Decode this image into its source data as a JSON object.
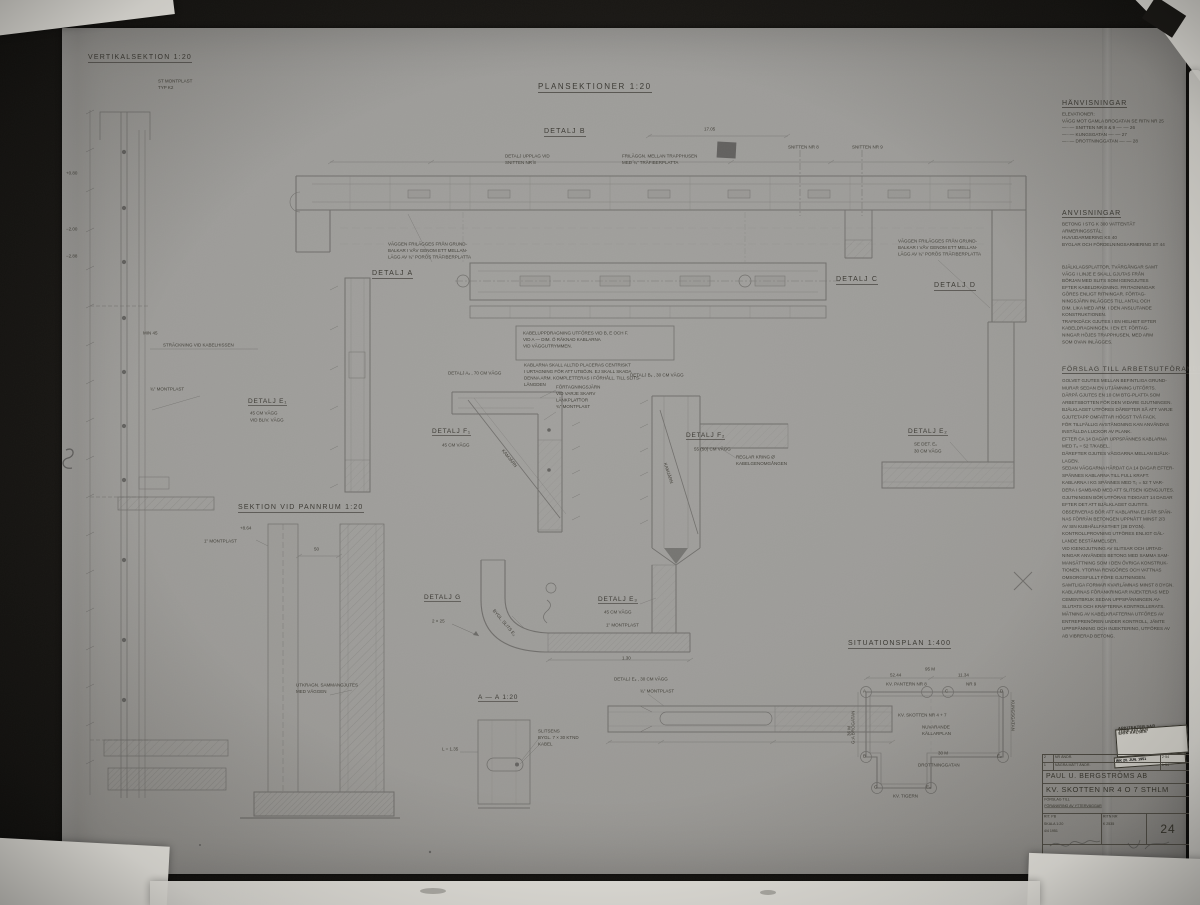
{
  "headings": {
    "vertical_section": "VERTIKALSEKTION 1:20",
    "plan_sections": "PLANSEKTIONER  1:20",
    "section_pannrum": "SEKTION VID PANNRUM  1:20",
    "situationsplan": "SITUATIONSPLAN  1:400",
    "section_aa": "A — A   1:20"
  },
  "labels": {
    "detail_a": "DETALJ A",
    "detail_b": "DETALJ B",
    "detail_c": "DETALJ C",
    "detail_d": "DETALJ D",
    "detail_e1": "DETALJ E₁",
    "detail_e1_sub": "45 CM VÄGG",
    "detail_e1_sub2": "VID BLIV. VÄGG",
    "detail_a2": "DETALJ A₂ , 70 CM VÄGG",
    "detail_b2": "DETALJ B₂ , 30 CM VÄGG",
    "detail_f1": "DETALJ F₁",
    "detail_f1_sub": "45 CM VÄGG",
    "detail_f2": "DETALJ F₂",
    "detail_f2_sub": "55 (50) CM VÄGG",
    "detail_e2": "DETALJ E₂",
    "detail_e2_sub": "SE DET. E₁",
    "detail_e2_sub2": "30 CM VÄGG",
    "detail_g": "DETALJ G",
    "detail_g_dim": "2 × 25",
    "detail_e3": "DETALJ E₃",
    "detail_e3_sub": "45 CM VÄGG",
    "detail_e3_sub2": "1\" MONTPLAST",
    "detail_e3b": "DETALJ E₃ , 30 CM VÄGG",
    "detail_e3b_sub": "¾\" MONTPLAST",
    "snitt8": "SNITTEN NR 8",
    "snitt9": "SNITTEN NR 9",
    "dim_1705": "17.05",
    "min45": "MIN 45",
    "stretch_note": "STRÄCKNING VID KABELHISSEN",
    "montplast34": "¾\" MONTPLAST",
    "montplast1": "1\" MONTPLAST",
    "level_864": "+8.64",
    "dim50": "50",
    "dim130": "1.30",
    "l135": "L = 1.35",
    "kamjarn": "KAMJÄRN",
    "bygl_slits": "BYGL. SLITS E₃",
    "level_080": "+0.80",
    "level_200": "−2.00",
    "level_288": "−2.88"
  },
  "notes": {
    "topleft": [
      "ST MONTPLAST",
      "TYP K2"
    ],
    "upplag": [
      "DETALJ UPPLAG VID",
      "SNITTEN NR 8"
    ],
    "frilaggn": [
      "FRILÄGGN. MELLAN TRAPPHUSEN",
      "MED ¾\" TRÄFIBERPLATTA"
    ],
    "frilagg_left": [
      "VÄGGEN FRILÄGGES FRÅN GRUND-",
      "BALKAR I VÅV GENOM ETT MELLAN-",
      "LÄGG AV ¾\" PORÖS TRÄFIBERPLATTA"
    ],
    "frilagg_right": [
      "VÄGGEN FRILÄGGES FRÅN GRUND-",
      "BALKAR I VÅV GENOM ETT MELLAN-",
      "LÄGG AV ¾\" PORÖS TRÄFIBERPLATTA"
    ],
    "boxed": [
      "KABELUPPDRAGNING UTFÖRES VID B, E OCH F.",
      "VID A  —  DIM. Ö RÄKNAD KABLARNA",
      "VID VÄGGUTRYMMEN."
    ],
    "kablarna": [
      "KABLARNA SKALL ALLTID PLACERAS CENTRISKT",
      "I URTAGNING FÖR ATT UTBÖJN. EJ SKALL SKADA",
      "DENNA ARM. KOMPLETTERAS I FÖRHÅLL. TILL SLITS-",
      "LÄNGDEN"
    ],
    "f1_notes": [
      "FÖRTAGNINGSJÄRN",
      "VID VARJE SKARV",
      "LÄNKPLATTOR",
      "¾\" MONTPLAST"
    ],
    "f2_note": [
      "REGLAR KRING Ø",
      "KABELGENOMGÅNGEN"
    ],
    "utkragn": [
      "UTKRAGN. SAMMANGJUTES",
      "MED VÄGGEN"
    ],
    "slits": [
      "SLITSENS",
      "BYGL. 7 × 30 KTND",
      "KABEL"
    ]
  },
  "references": {
    "title": "HÄNVISNINGAR",
    "lines": [
      "ELEVATIONER:",
      "VÄGG MOT GAMLA BROGATAN  SE RITN NR 25",
      " —··—   SNITTEN NR 8 & 9     —··—    26",
      " —··—   KUNGSGATAN         —··—    27",
      " —··—   DROTTNINGGATAN    —··—    28"
    ]
  },
  "instructions": {
    "title": "ANVISNINGAR",
    "lines": [
      "BETONG I STG  K 300  VATTENTÄT",
      "ARMERINGSSTÅL:",
      "HUVUDARMERING  KS 40",
      "BYGLAR OCH FÖRDELNINGSARMERING ST 44"
    ],
    "paragraph": [
      "BJÄLKLAGSPLATTOR, TVÄRGÅNGAR SAMT",
      "VÄGG I LINJE E SKALL GJUTAS FRÅN",
      "BÖRJAN MED SLITS SOM IGENGJUTES",
      "EFTER KABELDRAGNING. FRITAGNINGAR",
      "GÖRES ENLIGT RITNINGAR. FÖRTAG-",
      "NINGSJÄRN INLÄGGES TILL ANTAL OCH",
      "DIM. LIKA MED ARM. I DEN ANSLUTANDE",
      "KONSTRUKTIONEN.",
      "TRAFIKDÄCK GJUTES I EN HELHET EFTER",
      "KABELDRAGNINGEN. I EN ET. FÖRTAG-",
      "NINGAR HÖJES TRAPPHUSEN, MED ARM",
      "SOM OVAN INLÄGGES."
    ]
  },
  "work_proposal": {
    "title": "FÖRSLAG TILL ARBETSUTFÖRANDE",
    "lines": [
      "GOLVET GJUTES MELLAN BEFINTLIGA GRUND-",
      "MURAR SEDAN EN UTJÄMNING UTFÖRTS.",
      "DÄRPÅ GJUTES EN 10 CM BTG-PLATTA SOM",
      "ARBETSBOTTEN FÖR DEN VIDARE GJUTNINGEN.",
      "BJÄLKLAGET UTFÖRES DÄREFTER SÅ ATT VARJE",
      "GJUTETAPP OMFATTAR HÖGST TVÅ FACK.",
      "FÖR TILLFÄLLIG AVSTÄNGNING KAN ANVÄNDAS",
      "INSTÄLLDA LUCKOR AV PLANK.",
      "EFTER CA 14 DAGAR UPPSPÄNNES KABLARNA",
      "MED T₀ = 52 T/KABEL.",
      "DÄREFTER GJUTES VÄGGARNA MELLAN BJÄLK-",
      "LAGEN.",
      "SEDAN VÄGGARNA HÄRDAT CA 14 DAGAR EFTER-",
      "SPÄNNES KABLARNA TILL FULL KRAFT.",
      "KABLARNA I KG SPÄNNES MED T₀ = 52 T VAR-",
      "DERA I SAMBAND MED ATT SLITSEN IGENGJUTES.",
      "GJUTNINGEN BÖR UTFÖRAS TIDIGAST 14 DAGAR",
      "EFTER DET ATT BJÄLKLAGET GJUTITS.",
      "OBSERVERAS BÖR ATT KABLARNA EJ FÅR SPÄN-",
      "NAS FÖRRÄN BETONGEN UPPNÅTT MINST 2/3",
      "AV SIN KUBHÅLLFASTHET (28 DYGN).",
      "KONTROLLPROVNING UTFÖRES ENLIGT GÄL-",
      "LANDE BESTÄMMELSER.",
      "VID IGENGJUTNING AV SLITSAR OCH URTAG-",
      "NINGAR ANVÄNDES BETONG MED SAMMA SAM-",
      "MANSÄTTNING SOM I DEN ÖVRIGA KONSTRUK-",
      "TIONEN. YTORNA RENGÖRES OCH VATTNAS",
      "OMSORGSFULLT FÖRE GJUTNINGEN.",
      "SAMTLIGA FORMAR KVARLÄMNAS MINST 8 DYGN.",
      "KABLARNAS FÖRANKRINGAR INJEKTERAS MED",
      "CEMENTBRUK SEDAN UPPSPÄNNINGEN AV-",
      "SLUTATS OCH KRAFTERNA KONTROLLERATS.",
      "MÄTNING AV KABELKRAFTERNA UTFÖRES AV",
      "ENTREPRENÖREN UNDER KONTROLL, JÄMTE",
      "UPPSPÄNNING OCH INJEKTERING, UTFÖRES AV",
      "AB VIBRERAD BETONG."
    ]
  },
  "site_plan": {
    "block_top_left": "KV. PANTERN  NR 8",
    "block_top_right": "NR 9",
    "block_center": "KV. SKOTTEN  NR 4 + 7",
    "block_center2": [
      "NUVARANDE",
      "KÄLLARPLAN"
    ],
    "street_bottom": "DROTTNINGGATAN",
    "street_left": "G:A BROGATAN",
    "street_right": "KUNGSGATAN",
    "block_bottom": "KV. TIGERN",
    "dim_top": "95 M",
    "dim_52": "52.44",
    "dim_11": "11.34",
    "dim_30": "30 M",
    "dim_36": "36 M",
    "corner_a": "A",
    "corner_c": "C",
    "corner_d": "D",
    "corner_b": "B",
    "corner_e2": "E₂",
    "corner_g": "G",
    "corner_e3": "E₃"
  },
  "stamp": {
    "line1": "ERIK AHLSÉN",
    "line2": "TORE AHLSÉN",
    "line3": "ARKITEKTER SAR",
    "ink": "INK  20. JUN. 1951"
  },
  "title_block": {
    "rev1_no": "2",
    "rev1_text": "NR ÄNDR.",
    "rev1_date": "2·54",
    "rev2_no": "1",
    "rev2_text": "NÅGRA MÅTT ÄNDR.",
    "rev2_date": "1·54",
    "company": "PAUL U. BERGSTRÖMS AB",
    "project": "KV. SKOTTEN NR 4 O 7 STHLM",
    "subject1": "FÖRSLAG TILL",
    "subject2": "FÖRANKRING AV YTTERVÄGGAR",
    "field_rit": "RIT.  PB",
    "field_skala": "SKALA  1:20",
    "field_datum": "4/4  1951",
    "ritn_label": "RITN NR",
    "project_no": "K 2535",
    "sheet_no": "24"
  }
}
